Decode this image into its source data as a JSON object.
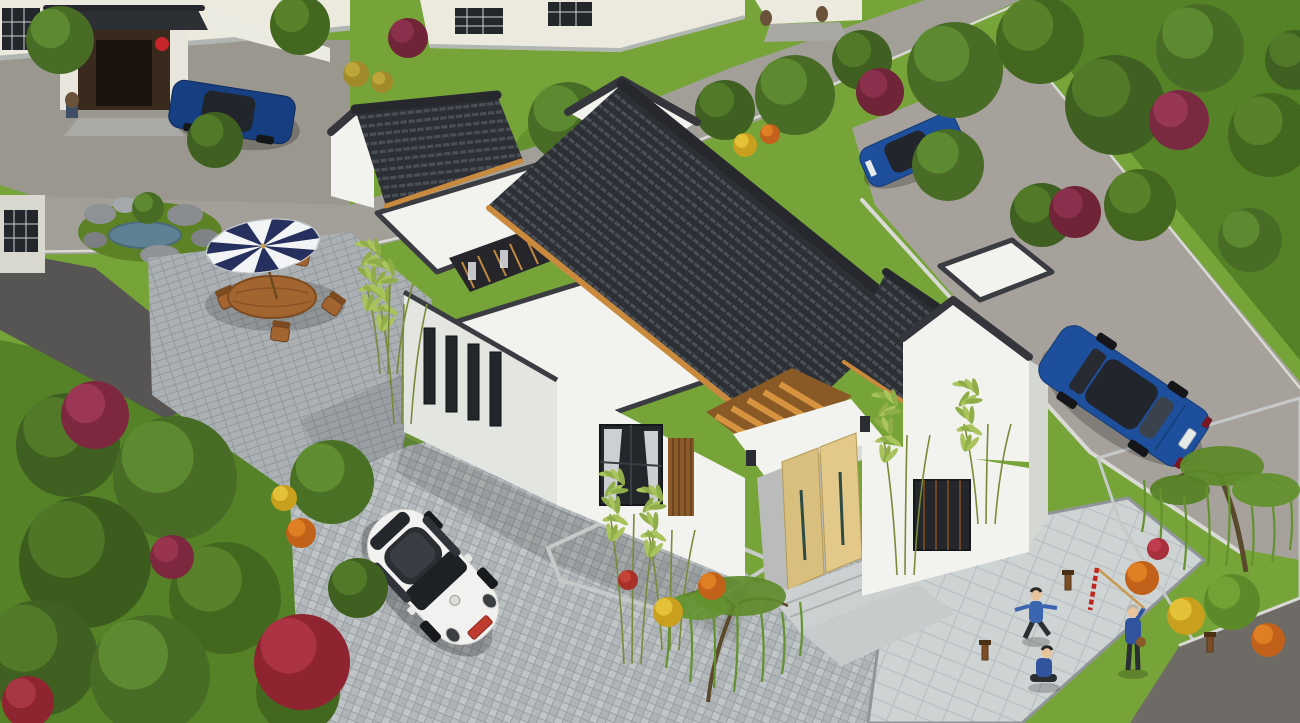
{
  "meta": {
    "alt": "Aerial 3D architectural rendering of a modern Chinese-style single-storey courtyard house with charcoal tiled pitched roofs, white walls, flat roof terraces, a light wooden entrance door, brick-paved courtyard with a white VW Beetle, a striped patio umbrella with wooden table and chairs, blue sedans on surrounding roads, gardens with trees, red and yellow flowering shrubs, and figures playing and lighting firecrackers on a paved plaza",
    "canvas_width": 1300,
    "canvas_height": 723
  },
  "objects": [
    "chinese-courtyard-house",
    "white-vw-beetle",
    "blue-sedan-right-road",
    "blue-sedan-top-left",
    "blue-sedan-top-right",
    "patio-umbrella-dining-set",
    "rock-garden-pond",
    "neighbor-gate-with-lions-and-lanterns",
    "people-lighting-firecrackers",
    "bamboo-plants",
    "willow-trees",
    "flower-shrubs",
    "paved-driveway",
    "stone-plaza"
  ],
  "palette": {
    "grass_base": "#76a438",
    "grass_dark": "#507c23",
    "road": "#a29f99",
    "road_right": "#a6a29b",
    "road_dark": "#6e6a66",
    "path_dark": "#565553",
    "forecourt": "#9a978f",
    "wall_white": "#f2f3ef",
    "wall_shade": "#e2e5e0",
    "wall_cream": "#eceade",
    "stone_base": "#b2b6b2",
    "window_dark": "#23262b",
    "curtain": "#dfe3e6",
    "screen_wood": "#8a5a2a",
    "roof_dark": "#2c2f34",
    "roof_light": "#4a4f57",
    "pergola_wood": "#cf8f3e",
    "door_wood_a": "#e2c98a",
    "door_wood_b": "#d9bf7e",
    "porch_shadow": "#b9bcba",
    "steps": "#ccd0d0",
    "walkway": "#c6cbcb",
    "drum_stone": "#c7cac9",
    "paving_joint": "#9aa0a3",
    "paving_a": "#b9bec0",
    "paving_b": "#adb3b6",
    "paving_c": "#c0c5c7",
    "paving_d": "#b4b9bc",
    "patio_joint": "#8f9497",
    "patio_brick": "#aab0b3",
    "plaza_joint": "#b9bec0",
    "plaza_tile": "#ced3d4",
    "water": "#5e8294",
    "rock_gray": "#8f9294",
    "furniture_wood": "#a2652f",
    "furniture_dark": "#7d4b20",
    "car_white": "#f1f1ef",
    "car_blue": "#1d4f9c",
    "car_blue_dark": "#153f80",
    "glass_dark": "#22262c",
    "plate_red": "#bf3b2e",
    "plate_white": "#e8eaea",
    "lantern_red": "#c6262a",
    "gate_wood": "#3a2a1e",
    "lion_stone": "#6a533a",
    "lion_base": "#3e4e66",
    "skin": "#e8c49c",
    "jacket_blue": "#3a66b0",
    "jacket_blue_dark": "#30549e",
    "pants_dark": "#2b2e33",
    "lamp_wood": "#7a4e26",
    "firecracker_red": "#c1271f",
    "pole_bamboo": "#c89a52",
    "bamboo_stem": "#7a8a3a",
    "bamboo_leaf_1": "#8fae4a",
    "bamboo_leaf_2": "#a9c45c",
    "trunk_brown": "#5a4a2c",
    "willow_green": "#63922f"
  },
  "scene": {
    "umbrella": {
      "cx": 263,
      "cy": 246,
      "rx": 57,
      "ry": 26,
      "rot": -8,
      "wedges": 14,
      "color_a": "#25305e",
      "color_b": "#f2f4f6"
    },
    "foliage_back": [
      [
        60,
        40,
        34,
        "#486c26",
        "#628f34"
      ],
      [
        300,
        25,
        30,
        "#44671f",
        "#5c862c"
      ],
      [
        215,
        140,
        28,
        "#3f6020",
        "#567e2a"
      ],
      [
        568,
        122,
        40,
        "#486c26",
        "#628f34"
      ],
      [
        648,
        162,
        36,
        "#44671f",
        "#5c862c"
      ],
      [
        725,
        110,
        30,
        "#3f6020",
        "#567e2a"
      ],
      [
        795,
        95,
        40,
        "#486c26",
        "#628f34"
      ],
      [
        862,
        60,
        30,
        "#3f6020",
        "#567e2a"
      ],
      [
        955,
        70,
        48,
        "#486c26",
        "#628f34"
      ],
      [
        1040,
        40,
        44,
        "#44671f",
        "#5c862c"
      ],
      [
        1115,
        105,
        50,
        "#3f6020",
        "#567e2a"
      ],
      [
        1200,
        48,
        44,
        "#486c26",
        "#628f34"
      ],
      [
        1270,
        135,
        42,
        "#44671f",
        "#5c862c"
      ],
      [
        948,
        165,
        36,
        "#486c26",
        "#628f34"
      ],
      [
        1042,
        215,
        32,
        "#3f6020",
        "#567e2a"
      ],
      [
        1140,
        205,
        36,
        "#44671f",
        "#5c862c"
      ],
      [
        1250,
        240,
        32,
        "#486c26",
        "#628f34"
      ],
      [
        1295,
        60,
        30,
        "#3f6020",
        "#567e2a"
      ],
      [
        148,
        208,
        16,
        "#486c26",
        "#628f34"
      ],
      [
        408,
        38,
        20,
        "#6f2438",
        "#8f3350"
      ],
      [
        880,
        92,
        24,
        "#6f2438",
        "#8f3350"
      ],
      [
        1179,
        120,
        30,
        "#7a2a40",
        "#9c3a58"
      ],
      [
        1075,
        212,
        26,
        "#6f2438",
        "#8f3350"
      ],
      [
        356,
        74,
        13,
        "#a08a2a",
        "#c2a93c"
      ],
      [
        382,
        82,
        11,
        "#a08a2a",
        "#c2a93c"
      ],
      [
        745,
        145,
        12,
        "#c9a01e",
        "#e8c83c"
      ],
      [
        770,
        134,
        10,
        "#c2611a",
        "#e58426"
      ]
    ],
    "foliage_front": [
      [
        68,
        445,
        52,
        "#3f6020",
        "#567e2a"
      ],
      [
        175,
        478,
        62,
        "#486c26",
        "#628f34"
      ],
      [
        85,
        562,
        66,
        "#3c5c1e",
        "#527a28"
      ],
      [
        225,
        598,
        56,
        "#44671f",
        "#5c862c"
      ],
      [
        40,
        658,
        58,
        "#3f6020",
        "#567e2a"
      ],
      [
        150,
        675,
        60,
        "#486c26",
        "#628f34"
      ],
      [
        298,
        692,
        42,
        "#44671f",
        "#5c862c"
      ],
      [
        332,
        482,
        42,
        "#4a7026",
        "#639232"
      ],
      [
        358,
        588,
        30,
        "#3f6020",
        "#567e2a"
      ],
      [
        95,
        415,
        34,
        "#7e2840",
        "#a03a58"
      ],
      [
        302,
        662,
        48,
        "#8e2430",
        "#b23646"
      ],
      [
        172,
        557,
        22,
        "#7e2840",
        "#9e3652"
      ],
      [
        28,
        702,
        26,
        "#8e2430",
        "#ae3a48"
      ],
      [
        284,
        498,
        13,
        "#c9a01e",
        "#e8c83c"
      ],
      [
        301,
        533,
        15,
        "#c2611a",
        "#e58426"
      ],
      [
        668,
        612,
        15,
        "#c9a01e",
        "#e8c83c"
      ],
      [
        712,
        586,
        14,
        "#c2611a",
        "#e58426"
      ],
      [
        628,
        580,
        10,
        "#a83028",
        "#c84838"
      ],
      [
        1142,
        578,
        17,
        "#c2611a",
        "#e58426"
      ],
      [
        1186,
        616,
        19,
        "#c9a01e",
        "#e8c83c"
      ],
      [
        1268,
        640,
        17,
        "#c2611a",
        "#e58426"
      ],
      [
        1158,
        549,
        11,
        "#a8303c",
        "#c44054"
      ],
      [
        1232,
        602,
        28,
        "#5d8a28",
        "#76a637"
      ]
    ],
    "bamboo": [
      [
        632,
        664,
        150
      ],
      [
        670,
        650,
        120
      ],
      [
        905,
        575,
        140
      ],
      [
        986,
        524,
        100
      ],
      [
        402,
        424,
        120
      ],
      [
        388,
        374,
        90
      ]
    ]
  }
}
